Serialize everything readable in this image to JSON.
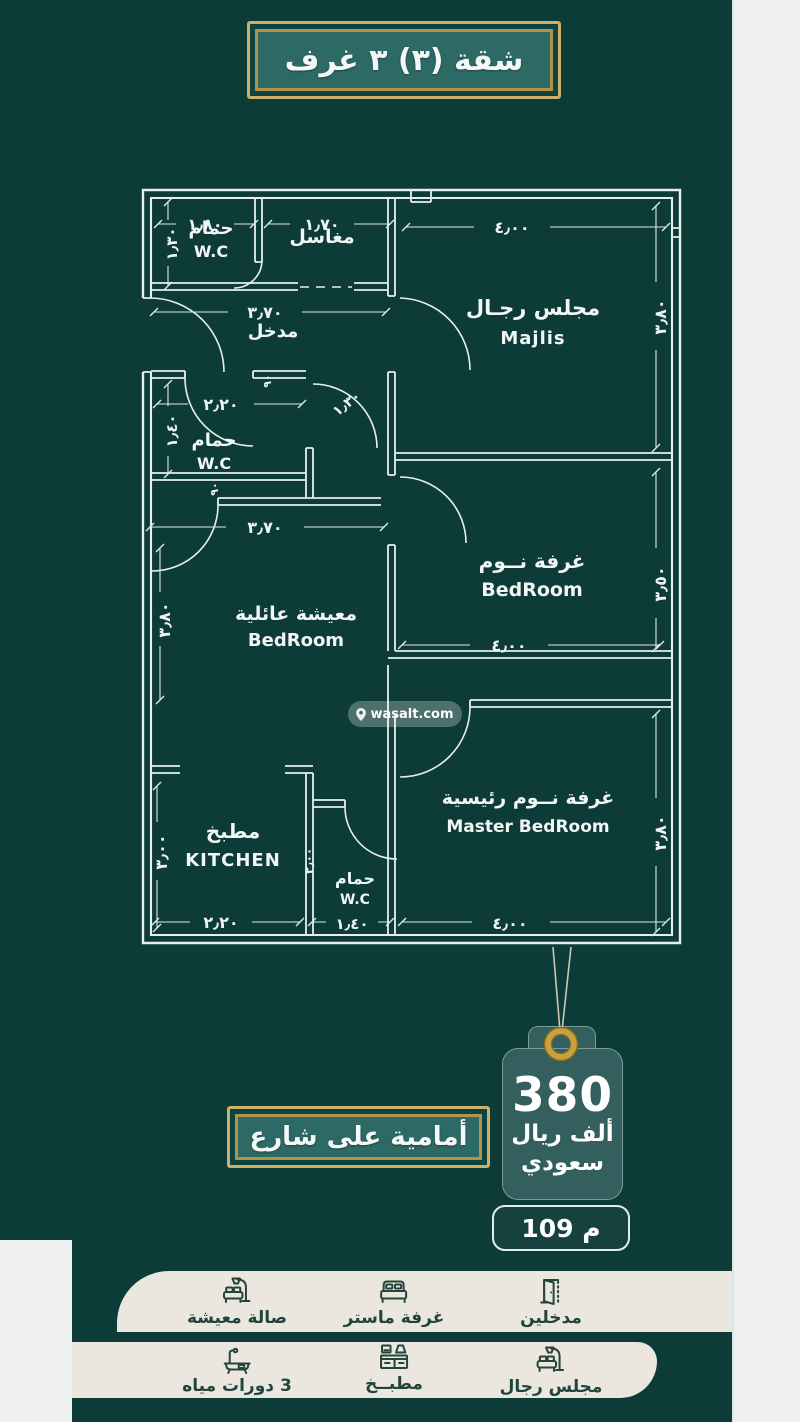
{
  "header": {
    "title": "شقة (٣) ٣ غرف"
  },
  "floorplan": {
    "watermark": "wasalt.com",
    "rooms": {
      "wc1": {
        "ar": "حمام",
        "en": "W.C"
      },
      "basins": {
        "ar": "مغاسل"
      },
      "majlis": {
        "ar": "مجلس رجـال",
        "en": "Majlis"
      },
      "entry": {
        "ar": "مدخل"
      },
      "wc2": {
        "ar": "حمام",
        "en": "W.C"
      },
      "bedroom": {
        "ar": "غرفة نــوم",
        "en": "BedRoom"
      },
      "family": {
        "ar": "معيشة عائلية",
        "en": "BedRoom"
      },
      "kitchen": {
        "ar": "مطبخ",
        "en": "KITCHEN"
      },
      "wc3": {
        "ar": "حمام",
        "en": "W.C"
      },
      "master": {
        "ar": "غرفة نــوم رئيسية",
        "en": "Master BedRoom"
      }
    },
    "dims": {
      "top_wc1": "١٫٨٠",
      "top_basins": "١٫٧٠",
      "top_majlis": "٤٫٠٠",
      "left_wc1": "١٫٣٠",
      "left_wc2": "١٫٤٠",
      "left_family": "٣٫٨٠",
      "left_kitchen": "٣٫٠٠",
      "right_majlis": "٣٫٨٠",
      "right_bedroom": "٣٫٥٠",
      "right_master": "٣٫٨٠",
      "entry_width": "٣٫٧٠",
      "wc2_width": "٢٫٢٠",
      "family_width": "٣٫٧٠",
      "hall_door": "١٫٣٠",
      "wc3_height": "٢٫٠٠",
      "door_small_1": "٩٠",
      "door_small_2": "٩٠",
      "bottom_kitchen": "٢٫٢٠",
      "bottom_wc3": "١٫٤٠",
      "bottom_master": "٤٫٠٠",
      "bedroom_width": "٤٫٠٠"
    }
  },
  "street_banner": {
    "label": "أمامية على شارع"
  },
  "price_tag": {
    "amount": "380",
    "currency_line1": "ألف ريال",
    "currency_line2": "سعودي",
    "area": "109 م"
  },
  "features": {
    "row1": [
      {
        "icon": "sofa-lamp-icon",
        "label": "صالة معيشة"
      },
      {
        "icon": "bed-icon",
        "label": "غرفة ماستر"
      },
      {
        "icon": "door-icon",
        "label": "مدخلين"
      }
    ],
    "row2": [
      {
        "icon": "bathtub-icon",
        "label": "3 دورات مياه"
      },
      {
        "icon": "kitchen-icon",
        "label": "مطبــخ"
      },
      {
        "icon": "sofa-lamp-icon",
        "label": "مجلس رجال"
      }
    ]
  }
}
